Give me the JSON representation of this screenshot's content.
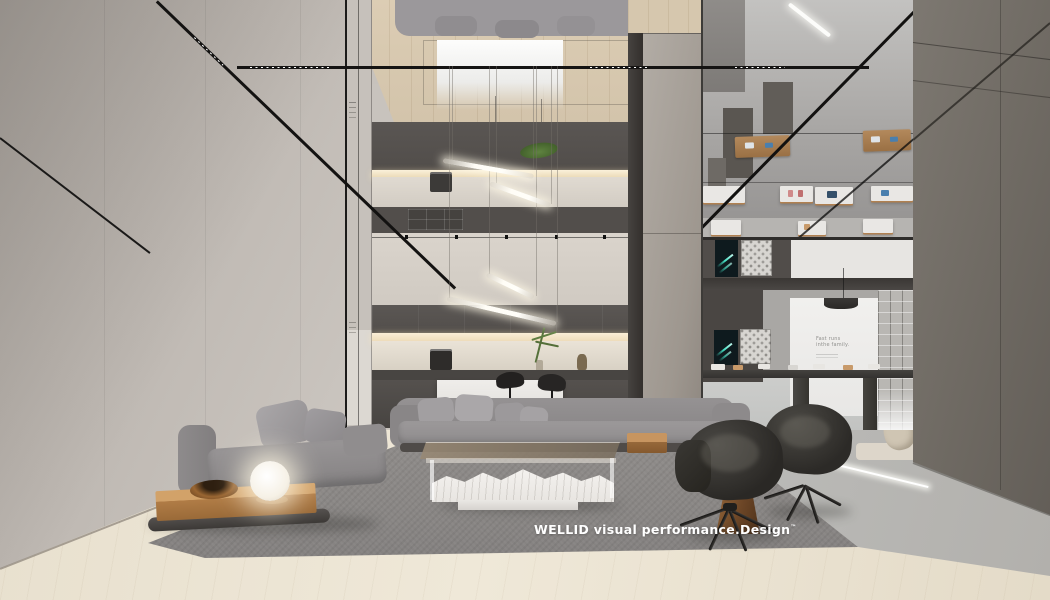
{
  "meta": {
    "type": "interior-architectural-render",
    "scene": "Double-height modern showroom living space: mirrored ceiling panels with black track lighting, two-storey dark cabinet wall with warm LED coves, slanted glass tube pendant lights, gray modular sofas on a gray rug, marble-base glass coffee table, oak side platform with bronze bowl and glowing sphere lamp, two dark leather lounge chairs with star bases, bronze cone side table, retail display tables with devices, teal graphic screens and 3D tile panel, tall taupe partition wall at right, light oak plank flooring"
  },
  "watermark": {
    "text": "WELLID visual performance.Design",
    "mark": "™"
  },
  "display_wall": {
    "poster_line1": "Fast runs",
    "poster_line2": "inthe family."
  },
  "palette": {
    "left_wall": "#beb8b2",
    "wood_ceiling": "#d9cab1",
    "wood_floor": "#e9e1d0",
    "cabinet_dark": "#54504d",
    "led_glow": "#f8ecd4",
    "column": "#a8a29b",
    "mirror": "#b4b2b0",
    "showroom_wall": "#4e4a47",
    "right_wall": "#726d66",
    "rug": "#8e8b89",
    "sofa_gray": "#969394",
    "oak": "#c0905c",
    "bronze": "#8a5f3a",
    "chair_leather": "#2e2c29",
    "marble": "#f4f2ef",
    "screen_teal": "#3fd8c0"
  },
  "furnishings": [
    "modular gray sofa",
    "chaise sofa",
    "marble coffee table",
    "leather armchairs",
    "bronze cone table",
    "sphere lamp",
    "bronze bowl",
    "bar stools",
    "kitchen island",
    "display tables",
    "tube pendant lights"
  ]
}
